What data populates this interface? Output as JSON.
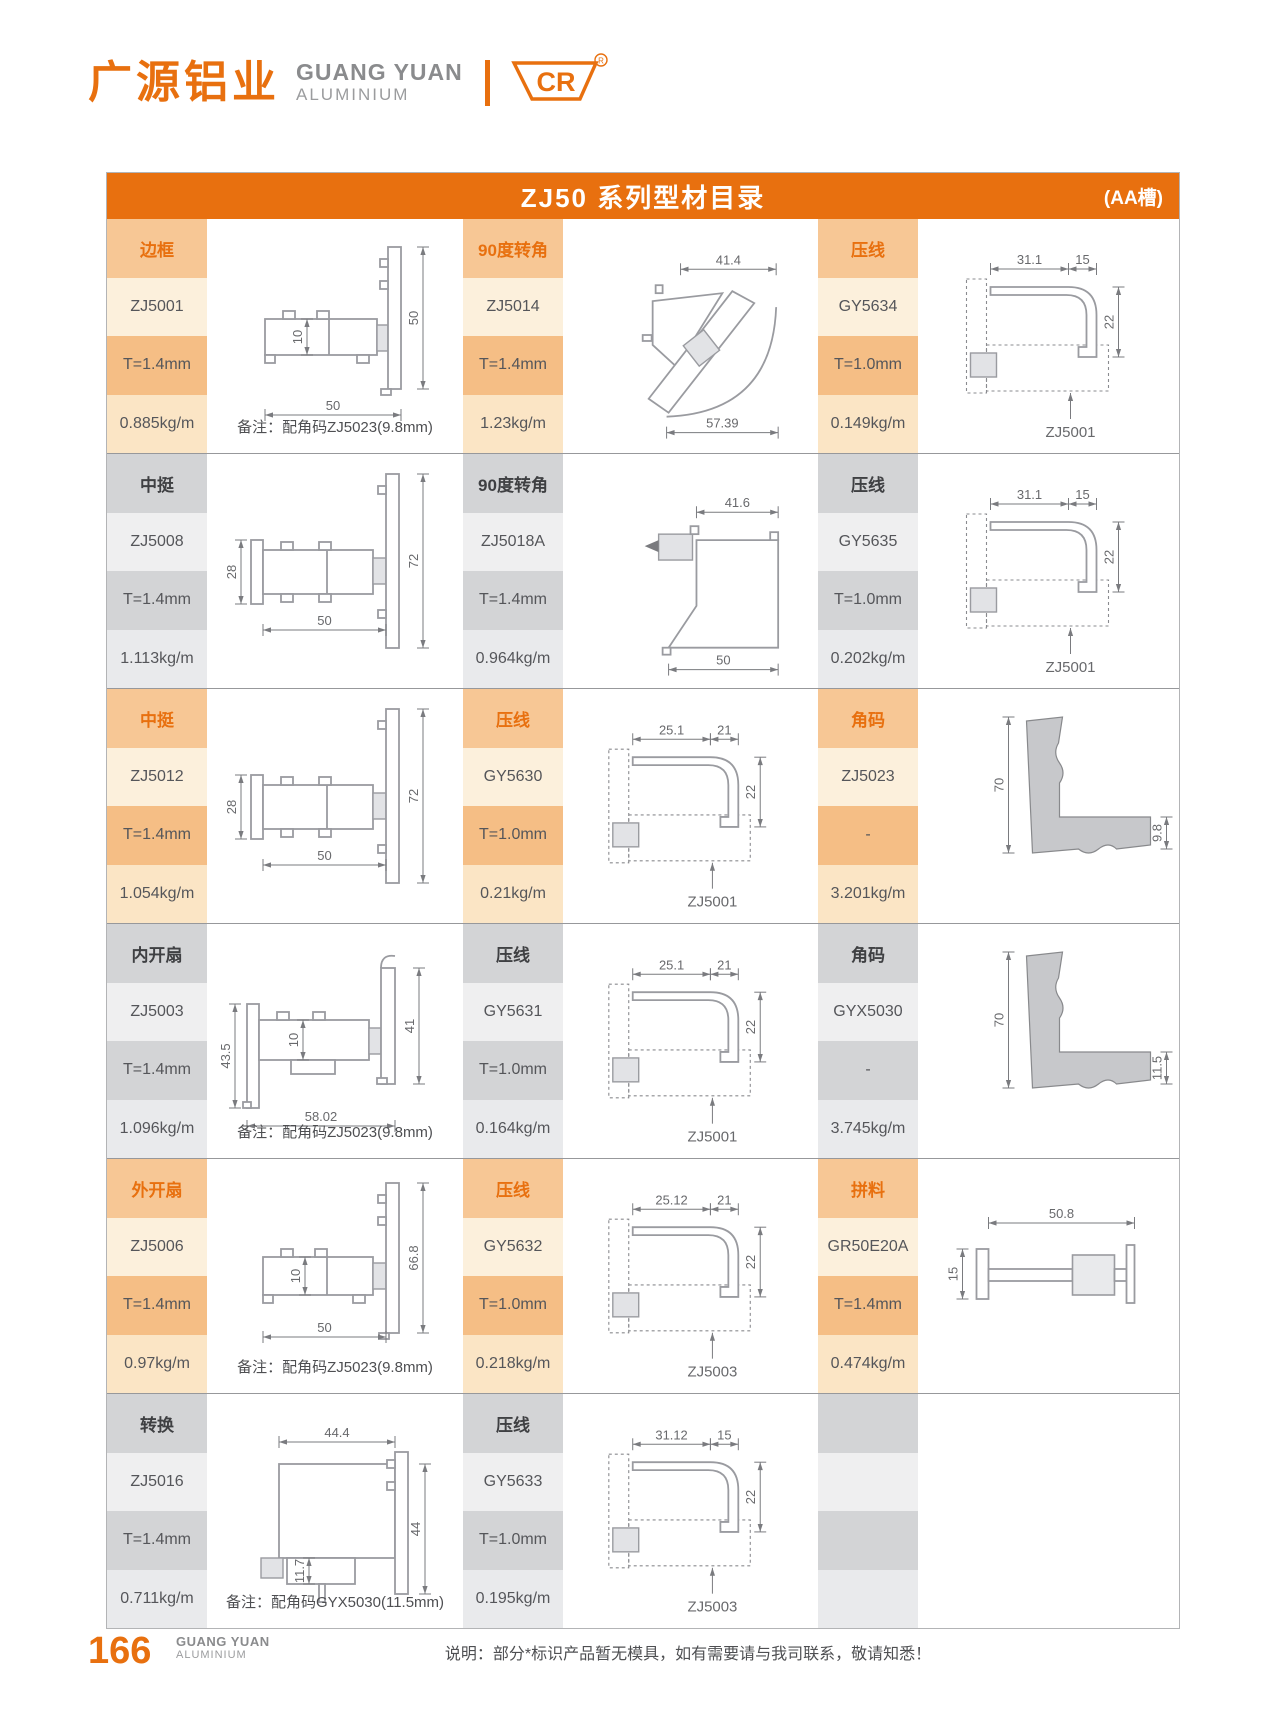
{
  "header": {
    "logo_cn": "广源铝业",
    "logo_en": "GUANG YUAN",
    "logo_sub": "ALUMINIUM",
    "badge": "CR",
    "badge_reg": "®"
  },
  "title": {
    "text": "ZJ50 系列型材目录",
    "tag": "(AA槽)"
  },
  "colors": {
    "brand_orange": "#E8700F",
    "row_orange": "#F7C795",
    "row_gray": "#D3D4D6"
  },
  "rows": [
    {
      "theme": "orange",
      "groups": [
        {
          "category": "边框",
          "model": "ZJ5001",
          "thickness": "T=1.4mm",
          "weight": "0.885kg/m",
          "note": "备注：配角码ZJ5023(9.8mm)",
          "diagram": {
            "type": "frame",
            "dims": [
              "10",
              "50",
              "50"
            ],
            "ref": ""
          }
        },
        {
          "category": "90度转角",
          "model": "ZJ5014",
          "thickness": "T=1.4mm",
          "weight": "1.23kg/m",
          "note": "",
          "diagram": {
            "type": "corner-z",
            "dims": [
              "41.4",
              "57.39"
            ],
            "ref": ""
          }
        },
        {
          "category": "压线",
          "model": "GY5634",
          "thickness": "T=1.0mm",
          "weight": "0.149kg/m",
          "note": "",
          "diagram": {
            "type": "bead",
            "dims": [
              "31.1",
              "15",
              "22"
            ],
            "ref": "ZJ5001"
          }
        }
      ]
    },
    {
      "theme": "gray",
      "groups": [
        {
          "category": "中挺",
          "model": "ZJ5008",
          "thickness": "T=1.4mm",
          "weight": "1.113kg/m",
          "note": "",
          "diagram": {
            "type": "mullion",
            "dims": [
              "28",
              "72",
              "50"
            ],
            "ref": ""
          }
        },
        {
          "category": "90度转角",
          "model": "ZJ5018A",
          "thickness": "T=1.4mm",
          "weight": "0.964kg/m",
          "note": "",
          "diagram": {
            "type": "corner-sq",
            "dims": [
              "41.6",
              "50"
            ],
            "ref": ""
          }
        },
        {
          "category": "压线",
          "model": "GY5635",
          "thickness": "T=1.0mm",
          "weight": "0.202kg/m",
          "note": "",
          "diagram": {
            "type": "bead",
            "dims": [
              "31.1",
              "15",
              "22"
            ],
            "ref": "ZJ5001"
          }
        }
      ]
    },
    {
      "theme": "orange",
      "groups": [
        {
          "category": "中挺",
          "model": "ZJ5012",
          "thickness": "T=1.4mm",
          "weight": "1.054kg/m",
          "note": "",
          "diagram": {
            "type": "mullion",
            "dims": [
              "28",
              "72",
              "50"
            ],
            "ref": ""
          }
        },
        {
          "category": "压线",
          "model": "GY5630",
          "thickness": "T=1.0mm",
          "weight": "0.21kg/m",
          "note": "",
          "diagram": {
            "type": "bead",
            "dims": [
              "25.1",
              "21",
              "22"
            ],
            "ref": "ZJ5001"
          }
        },
        {
          "category": "角码",
          "model": "ZJ5023",
          "thickness": "-",
          "weight": "3.201kg/m",
          "note": "",
          "diagram": {
            "type": "bracket",
            "dims": [
              "70",
              "9.8"
            ],
            "ref": ""
          }
        }
      ]
    },
    {
      "theme": "gray",
      "groups": [
        {
          "category": "内开扇",
          "model": "ZJ5003",
          "thickness": "T=1.4mm",
          "weight": "1.096kg/m",
          "note": "备注：配角码ZJ5023(9.8mm)",
          "diagram": {
            "type": "sash-in",
            "dims": [
              "43.5",
              "10",
              "58.02",
              "41"
            ],
            "ref": ""
          }
        },
        {
          "category": "压线",
          "model": "GY5631",
          "thickness": "T=1.0mm",
          "weight": "0.164kg/m",
          "note": "",
          "diagram": {
            "type": "bead",
            "dims": [
              "25.1",
              "21",
              "22"
            ],
            "ref": "ZJ5001"
          }
        },
        {
          "category": "角码",
          "model": "GYX5030",
          "thickness": "-",
          "weight": "3.745kg/m",
          "note": "",
          "diagram": {
            "type": "bracket",
            "dims": [
              "70",
              "11.5"
            ],
            "ref": ""
          }
        }
      ]
    },
    {
      "theme": "orange",
      "groups": [
        {
          "category": "外开扇",
          "model": "ZJ5006",
          "thickness": "T=1.4mm",
          "weight": "0.97kg/m",
          "note": "备注：配角码ZJ5023(9.8mm)",
          "diagram": {
            "type": "sash-out",
            "dims": [
              "10",
              "50",
              "66.8"
            ],
            "ref": ""
          }
        },
        {
          "category": "压线",
          "model": "GY5632",
          "thickness": "T=1.0mm",
          "weight": "0.218kg/m",
          "note": "",
          "diagram": {
            "type": "bead",
            "dims": [
              "25.12",
              "21",
              "22"
            ],
            "ref": "ZJ5003"
          }
        },
        {
          "category": "拼料",
          "model": "GR50E20A",
          "thickness": "T=1.4mm",
          "weight": "0.474kg/m",
          "note": "",
          "diagram": {
            "type": "joiner",
            "dims": [
              "50.8",
              "15"
            ],
            "ref": ""
          }
        }
      ]
    },
    {
      "theme": "gray",
      "groups": [
        {
          "category": "转换",
          "model": "ZJ5016",
          "thickness": "T=1.4mm",
          "weight": "0.711kg/m",
          "note": "备注：配角码GYX5030(11.5mm)",
          "diagram": {
            "type": "transform",
            "dims": [
              "44.4",
              "11.7",
              "44"
            ],
            "ref": ""
          }
        },
        {
          "category": "压线",
          "model": "GY5633",
          "thickness": "T=1.0mm",
          "weight": "0.195kg/m",
          "note": "",
          "diagram": {
            "type": "bead",
            "dims": [
              "31.12",
              "15",
              "22"
            ],
            "ref": "ZJ5003"
          }
        },
        {
          "category": "",
          "model": "",
          "thickness": "",
          "weight": "",
          "note": "",
          "diagram": {
            "type": "empty",
            "dims": [],
            "ref": ""
          }
        }
      ]
    }
  ],
  "footer": {
    "page": "166",
    "brand": "GUANG YUAN",
    "brand_sub": "ALUMINIUM",
    "note": "说明：部分*标识产品暂无模具，如有需要请与我司联系，敬请知悉！"
  }
}
